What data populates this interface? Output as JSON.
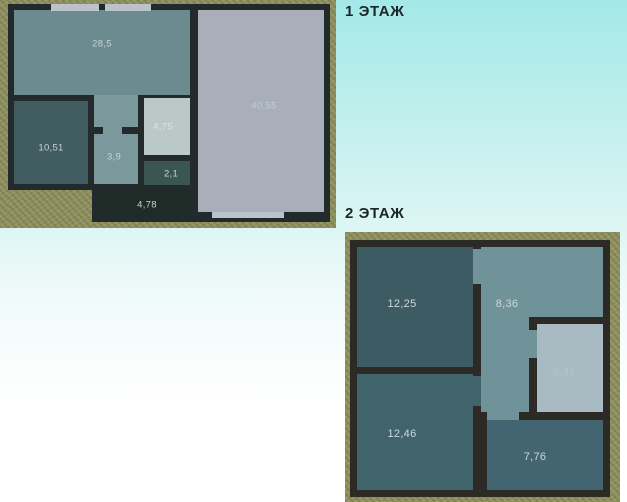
{
  "floor1": {
    "title": "1 ЭТАЖ",
    "rooms": {
      "r285": {
        "area": "28,5"
      },
      "r1051": {
        "area": "10,51"
      },
      "r39": {
        "area": "3,9"
      },
      "r475": {
        "area": "4,75"
      },
      "r21": {
        "area": "2,1"
      },
      "r478": {
        "area": "4,78"
      },
      "r4055": {
        "area": "40,55"
      }
    }
  },
  "floor2": {
    "title": "2 ЭТАЖ",
    "rooms": {
      "r1225": {
        "area": "12,25"
      },
      "r836": {
        "area": "8,36"
      },
      "r531": {
        "area": "5,31"
      },
      "r1246": {
        "area": "12,46"
      },
      "r776": {
        "area": "7,76"
      }
    }
  },
  "palette": {
    "background_top": "#a3e9e7",
    "background_bottom": "#ffffff",
    "ground": "#8f9160",
    "floor1_wall": "#222a2c",
    "floor2_wall": "#2b2a24",
    "room_28_5": "#6c8b90",
    "room_10_51": "#415d61",
    "hall_3_9": "#7b989d",
    "room_4_75": "#bac8c8",
    "room_2_1": "#3b5553",
    "porch_4_78": "#1f2b27",
    "room_40_55": "#a9aebb",
    "room_12_25": "#3c5b62",
    "corridor_8_36": "#70939a",
    "room_5_31": "#a8bac2",
    "room_12_46": "#40636c",
    "room_7_76": "#436571",
    "window": "#bcc2ca",
    "title_text": "#1d242a"
  }
}
